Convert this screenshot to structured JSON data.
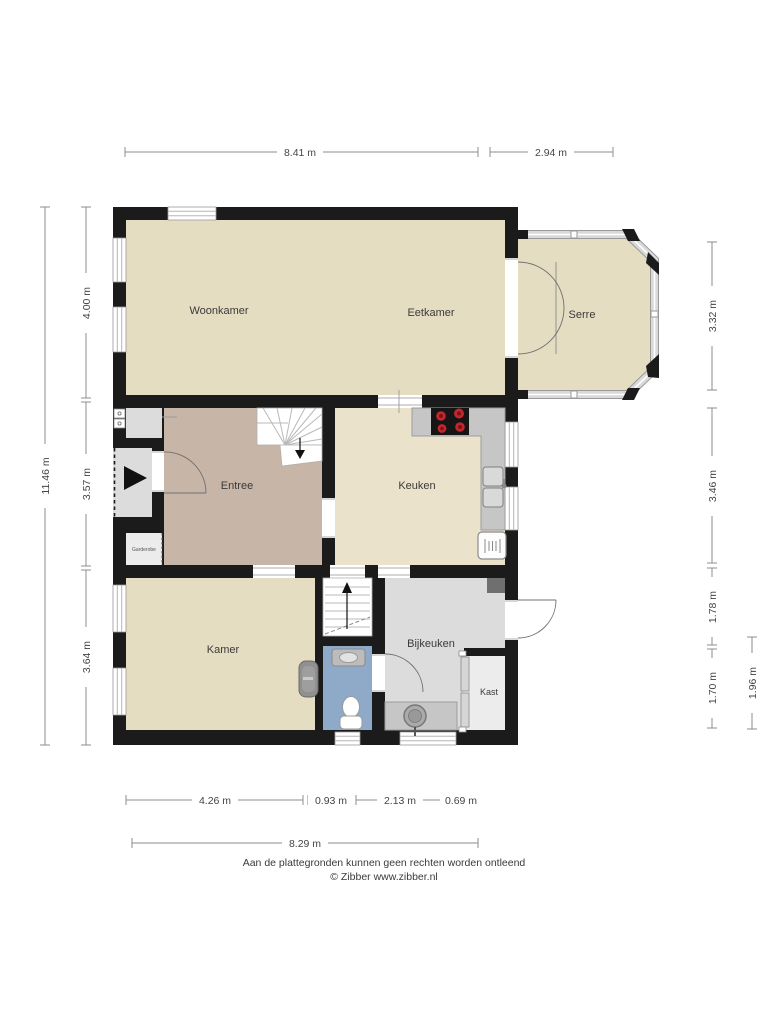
{
  "plan": {
    "rooms": {
      "woonkamer": "Woonkamer",
      "eetkamer": "Eetkamer",
      "serre": "Serre",
      "entree": "Entree",
      "keuken": "Keuken",
      "kamer": "Kamer",
      "bijkeuken": "Bijkeuken",
      "kast": "Kast",
      "garderobe": "Garderobe"
    }
  },
  "dimensions": {
    "top": [
      "8.41 m",
      "2.94 m"
    ],
    "left_total": "11.46 m",
    "left": [
      "4.00 m",
      "3.57 m",
      "3.64 m"
    ],
    "right": [
      "3.32 m",
      "3.46 m",
      "1.78 m",
      "1.70 m"
    ],
    "right_outer": "1.96 m",
    "bottom": [
      "4.26 m",
      "0.93 m",
      "2.13 m",
      "0.69 m"
    ],
    "bottom_total": "8.29 m"
  },
  "footer": {
    "disclaimer": "Aan de plattegronden kunnen geen rechten worden ontleend",
    "copyright": "© Zibber www.zibber.nl"
  },
  "colors": {
    "wall": "#1b1b1b",
    "floor_beige": "#e5ddc2",
    "floor_keuken": "#eae2cb",
    "floor_entree": "#c7b5a8",
    "floor_gray": "#dcdcdc",
    "floor_niche": "#ececec",
    "floor_toilet": "#8fa9c9",
    "counter": "#c6c6c6",
    "fixture_dark": "#6f6f6f",
    "burner_red": "#c1272d"
  }
}
